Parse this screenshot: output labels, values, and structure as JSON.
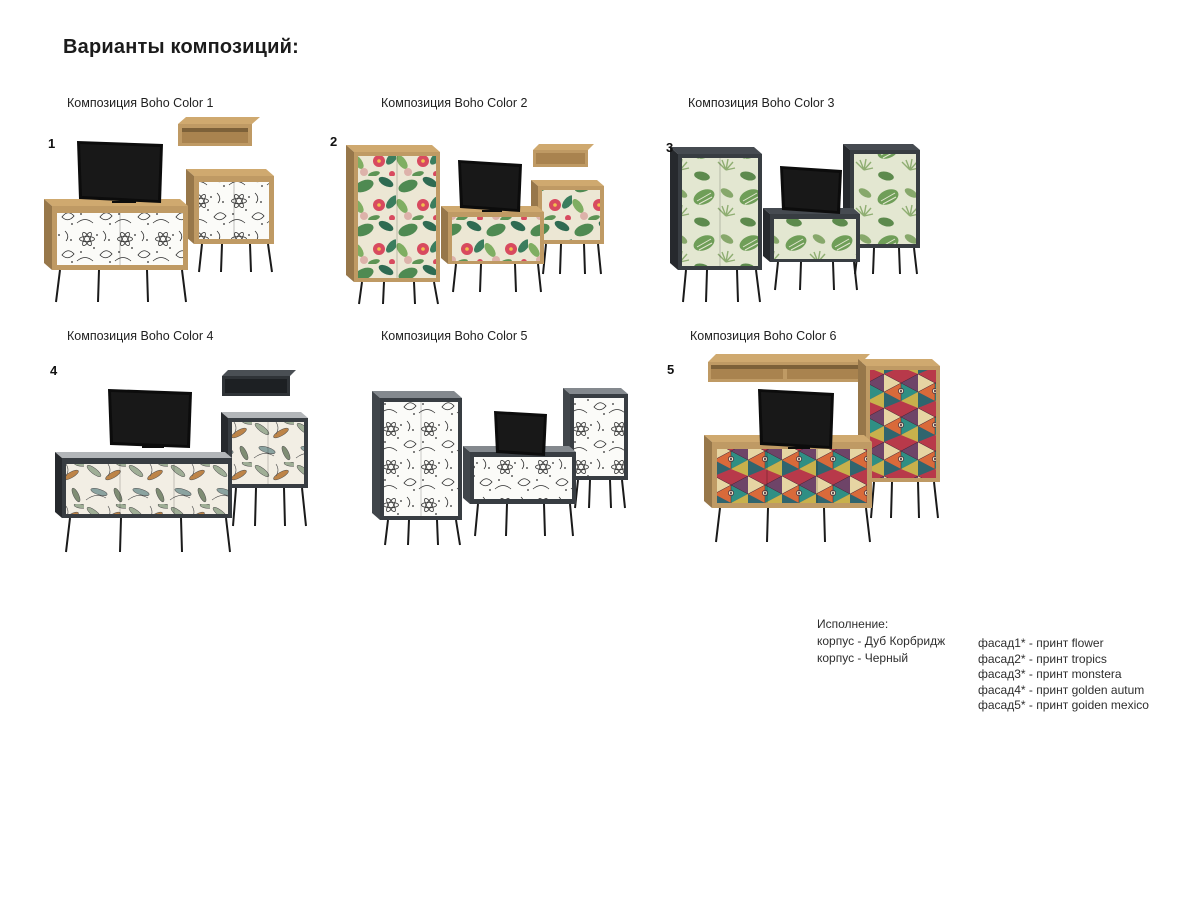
{
  "title": "Варианты композиций:",
  "compositions": [
    {
      "number": "1",
      "label": "Композиция Boho Color 1",
      "body": "oak",
      "print": "flower"
    },
    {
      "number": "2",
      "label": "Композиция Boho Color 2",
      "body": "oak",
      "print": "tropics"
    },
    {
      "number": "3",
      "label": "Композиция Boho Color 3",
      "body": "black",
      "print": "monstera"
    },
    {
      "number": "4",
      "label": "Композиция Boho Color 4",
      "body": "black",
      "print": "golden autum"
    },
    {
      "number": "",
      "label": "Композиция Boho Color 5",
      "body": "black",
      "print": "flower"
    },
    {
      "number": "5",
      "label": "Композиция Boho Color 6",
      "body": "oak",
      "print": "goiden mexico"
    }
  ],
  "legend": {
    "title": "Исполнение:",
    "korpus_lines": [
      "корпус - Дуб Корбридж",
      "корпус - Черный"
    ],
    "facade_lines": [
      "фасад1* - принт flower",
      "фасад2* - принт tropics",
      "фасад3* - принт monstera",
      "фасад4* - принт golden autum",
      "фасад5* - принт goiden mexico"
    ]
  },
  "colors": {
    "oak": "#bf9a64",
    "oak_top": "#cfa96f",
    "oak_side": "#97774a",
    "dark_body": "#383d42",
    "dark_side": "#26292d",
    "tv": "#0c0c0c",
    "legs": "#1a1a1a"
  }
}
